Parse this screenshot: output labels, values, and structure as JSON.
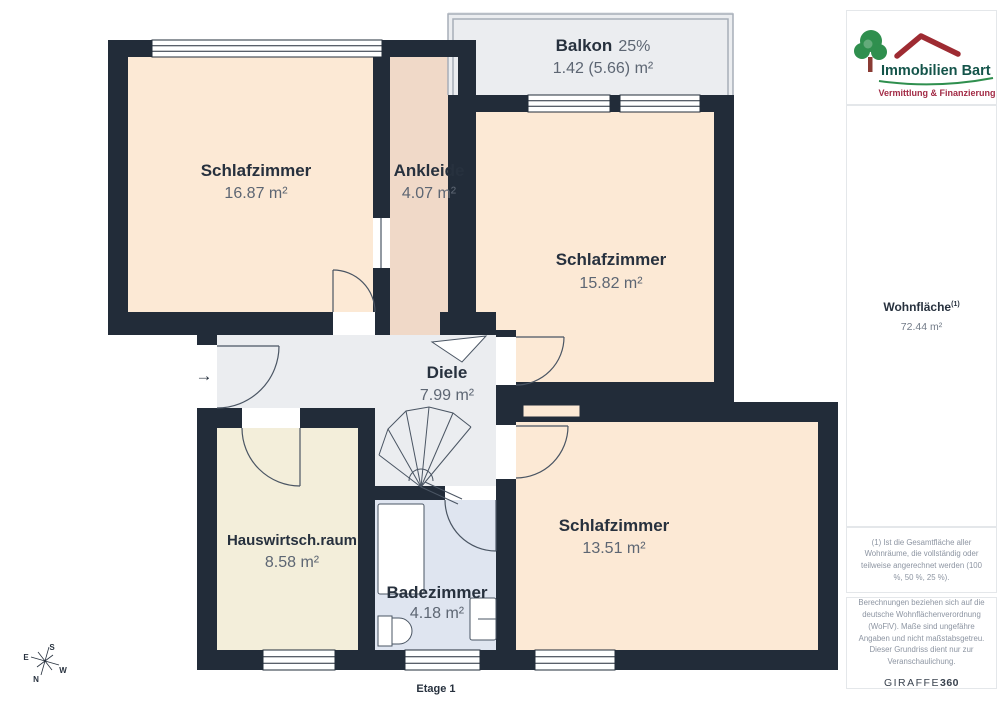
{
  "plan": {
    "floor_label": "Etage 1",
    "entrance_arrow": "→",
    "rooms": [
      {
        "id": "schlafzimmer-1",
        "name": "Schlafzimmer",
        "area": "16.87 m²"
      },
      {
        "id": "ankleide",
        "name": "Ankleide",
        "area": "4.07 m²"
      },
      {
        "id": "balkon",
        "name": "Balkon",
        "share": "25%",
        "area": "1.42 (5.66) m²"
      },
      {
        "id": "schlafzimmer-2",
        "name": "Schlafzimmer",
        "area": "15.82 m²"
      },
      {
        "id": "diele",
        "name": "Diele",
        "area": "7.99 m²"
      },
      {
        "id": "hauswirtschaftsraum",
        "name": "Hauswirtsch.raum",
        "area": "8.58 m²"
      },
      {
        "id": "badezimmer",
        "name": "Badezimmer",
        "area": "4.18 m²"
      },
      {
        "id": "schlafzimmer-3",
        "name": "Schlafzimmer",
        "area": "13.51 m²"
      }
    ],
    "compass": {
      "n": "N",
      "e": "E",
      "s": "S",
      "w": "W"
    }
  },
  "sidebar": {
    "logo": {
      "title": "Immobilien Bart",
      "subtitle": "Vermittlung & Finanzierung"
    },
    "living_area": {
      "label": "Wohnfläche",
      "footnote_marker": "(1)",
      "value": "72.44 m²"
    },
    "footnote1": "(1) Ist die Gesamtfläche aller Wohnräume, die vollständig oder teilweise angerechnet werden (100 %, 50 %, 25 %).",
    "disclaimer": "Berechnungen beziehen sich auf die deutsche Wohnflächenverordnung (WoFlV). Maße sind ungefähre Angaben und nicht maßstabsgetreu. Dieser Grundriss dient nur zur Veranschaulichung.",
    "brand": {
      "name": "GIRAFFE",
      "suffix": "360"
    }
  },
  "colors": {
    "wall": "#222c39",
    "bedroom_fill": "#fce9d5",
    "dressing_fill": "#f0d9c8",
    "hall_fill": "#ebedf0",
    "utility_fill": "#f3eeda",
    "bath_fill": "#dfe5f0",
    "balcony_fill": "#ebedf0",
    "room_name_text": "#27313e",
    "area_text": "#5d6673",
    "logo_tree_green": "#2f8f4e",
    "logo_text_green": "#14544a",
    "logo_roof_red": "#9e2b32",
    "logo_subtitle_red": "#a22a45"
  }
}
